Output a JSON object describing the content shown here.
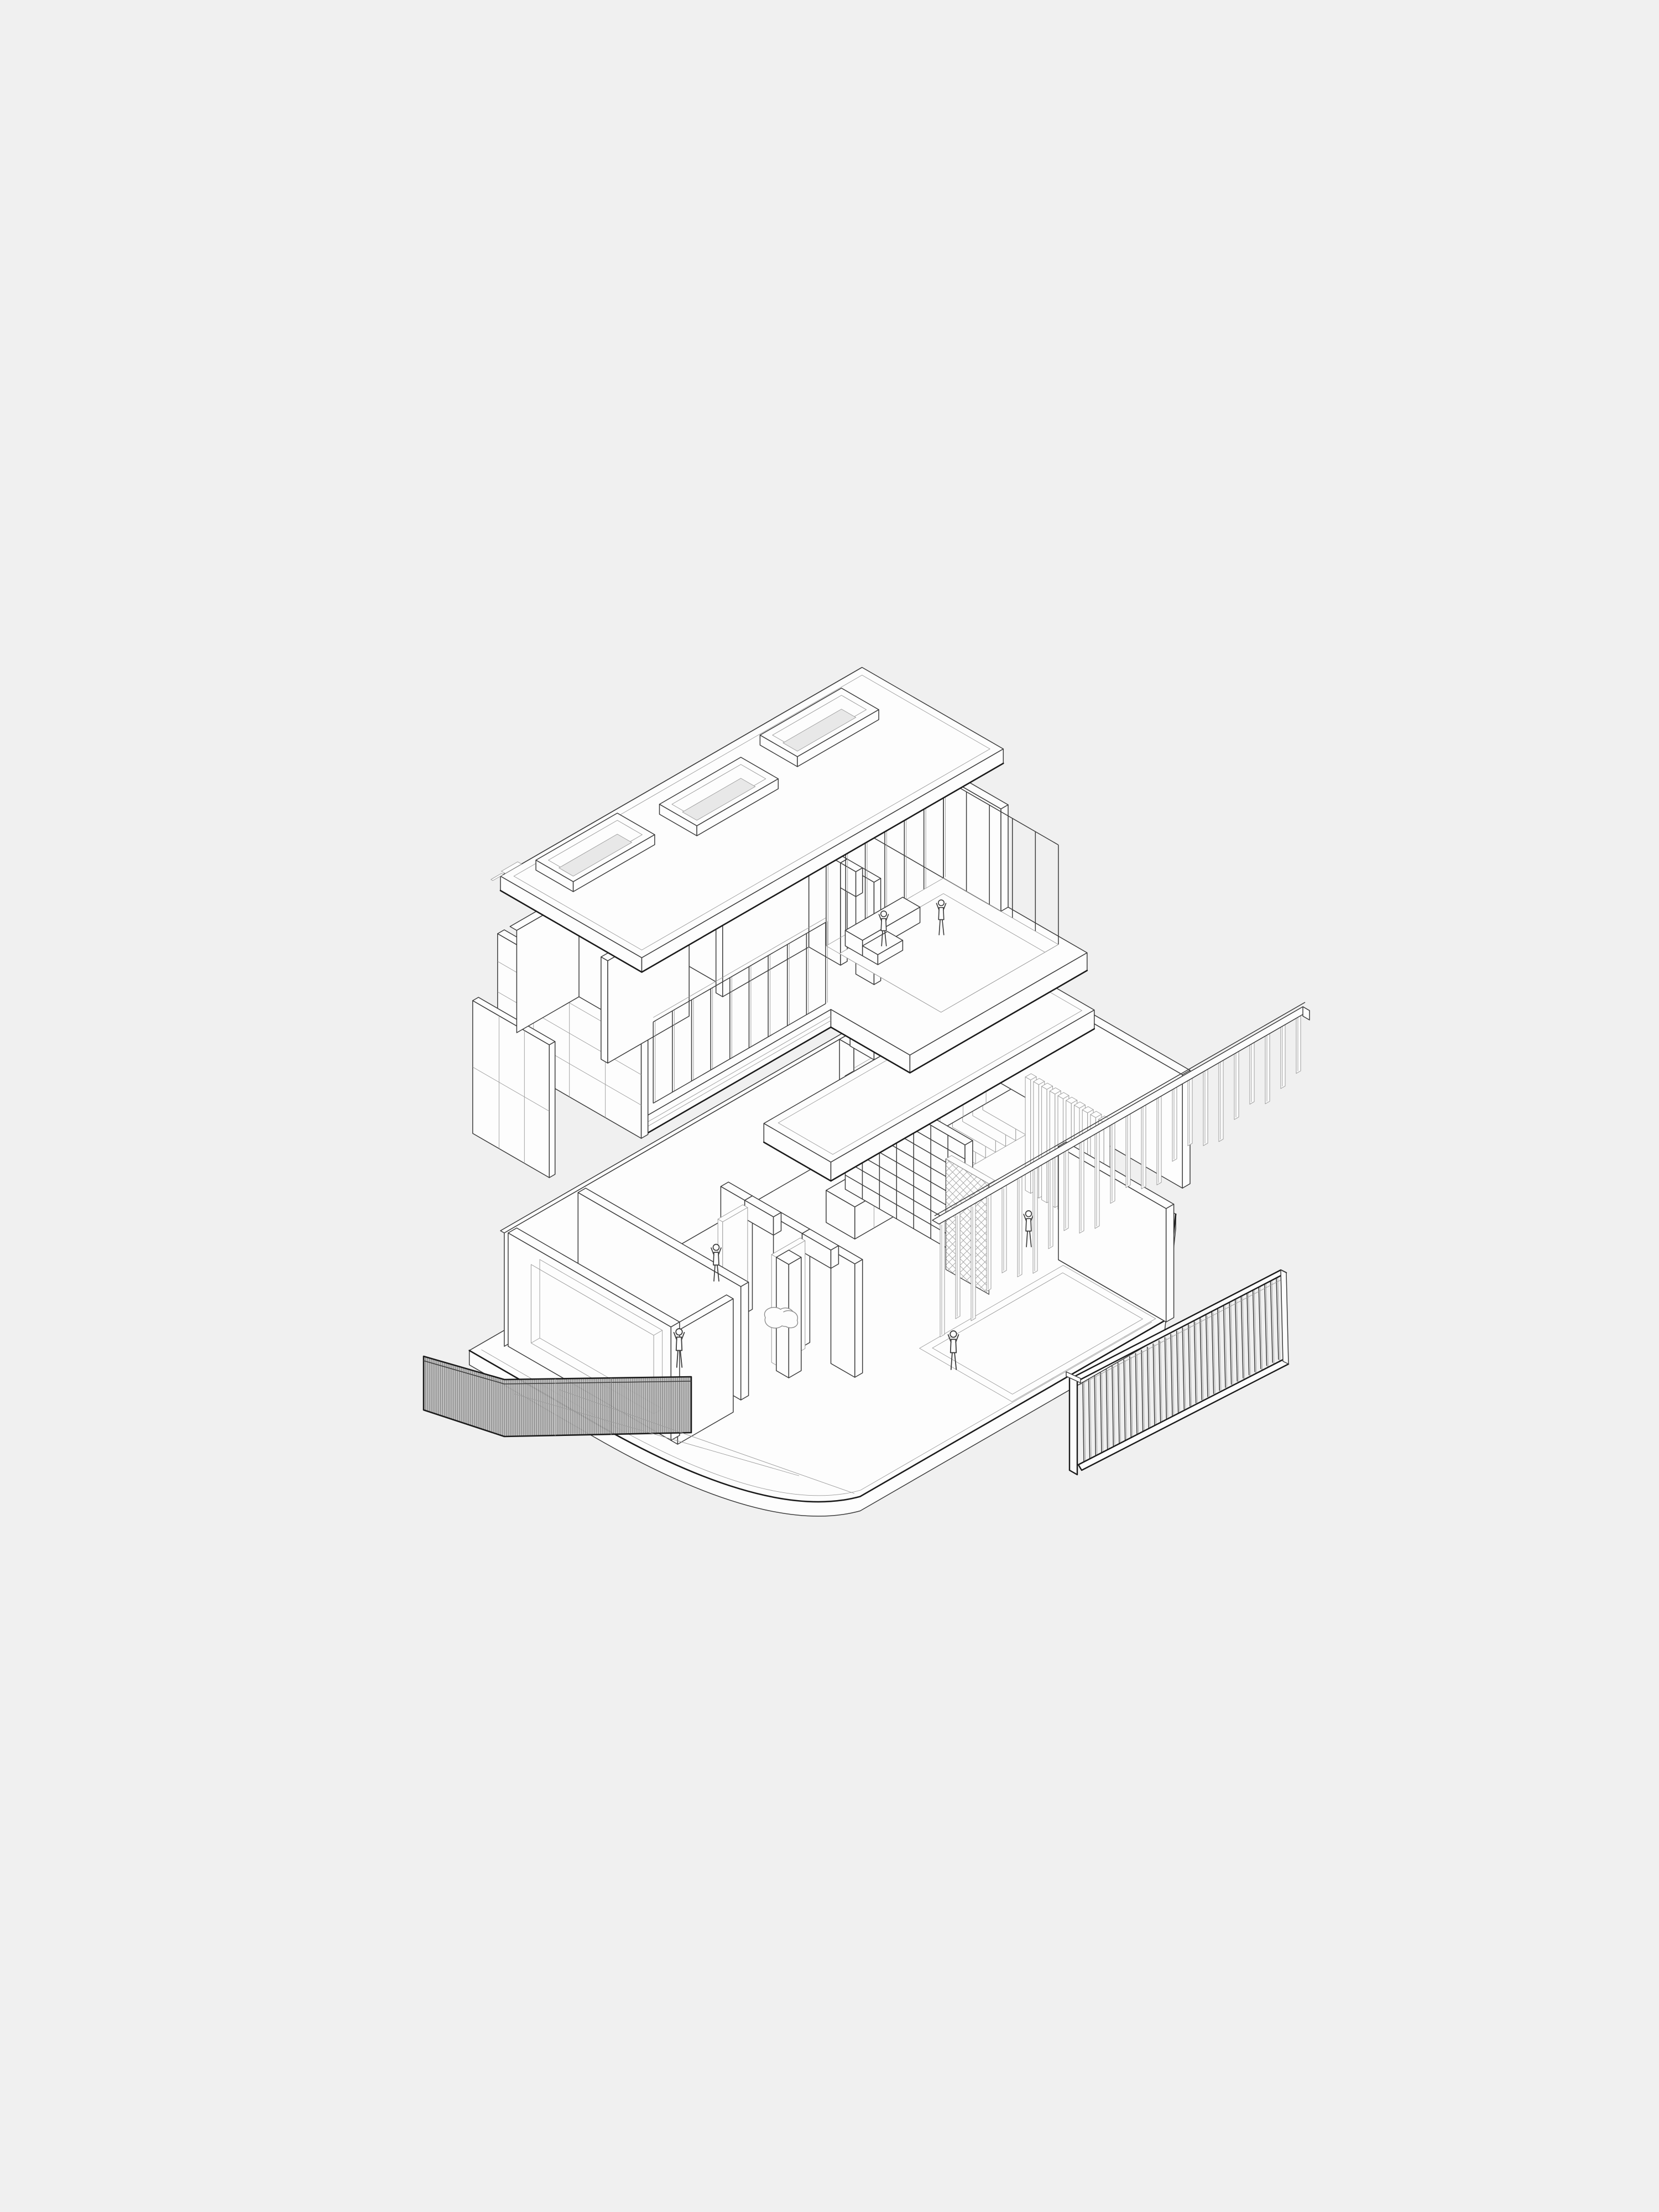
{
  "document": {
    "kind": "architectural-exploded-axonometric-drawing",
    "visible_text": []
  },
  "palette": {
    "background": "#f0f0f0",
    "line_bold": "#1b1b1b",
    "line": "#3c3c3c",
    "line_light": "#9a9a9a",
    "face": "#fdfdfd",
    "slot": "#e8e8e8",
    "dark": "#4a4a4a",
    "hatch_line": "#5f5f5f",
    "fence_base": "#cdcdcd"
  },
  "scene": {
    "roof": {
      "skylights": 3
    },
    "upper_floor": {
      "clerestory_panels": 5,
      "front_mullions": 10,
      "terrace_mullions": 7,
      "side_mullions": 6,
      "figures": [
        {
          "pose": "seated"
        },
        {
          "pose": "standing"
        }
      ]
    },
    "suspended_deck": {
      "support_columns": 1
    },
    "fin_rail_screen": {
      "fins": 24
    },
    "ground_floor": {
      "bookshelf": {
        "columns": 7,
        "rows": 8
      },
      "stair_steps": 8,
      "wall_fins": 10,
      "figures": [
        {
          "pose": "standing"
        },
        {
          "pose": "walking"
        },
        {
          "pose": "walking"
        },
        {
          "pose": "hanging"
        }
      ],
      "beanbags": 2
    },
    "fence_left": {
      "segments": 2
    },
    "slat_screen_right": {
      "slats": 34
    }
  }
}
